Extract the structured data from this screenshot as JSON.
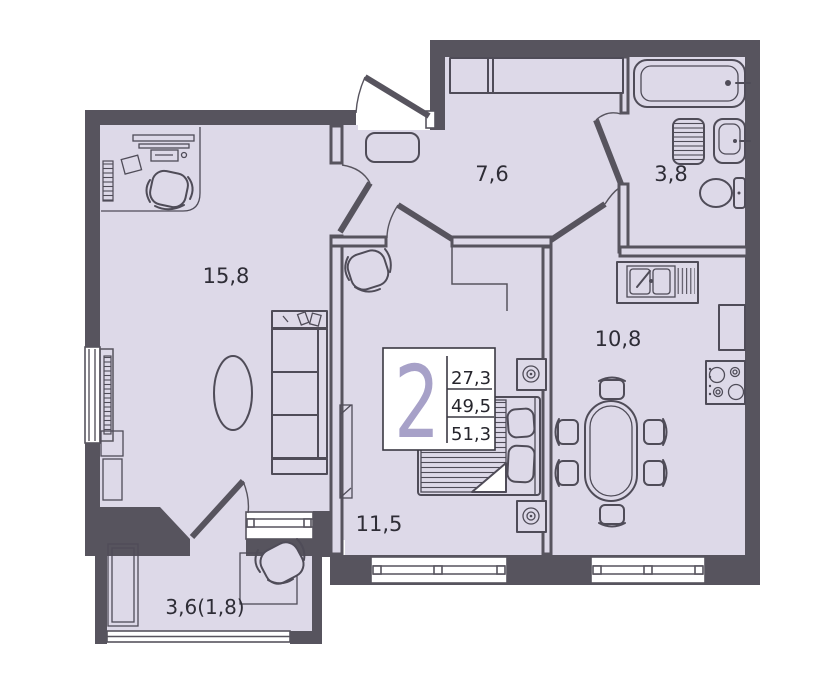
{
  "colors": {
    "wall": "#57545e",
    "floor": "#ddd9e8",
    "line": "#4f4c58",
    "accent": "#a7a1c8",
    "text": "#2e2d36",
    "paper": "#ffffff"
  },
  "rooms": {
    "living": {
      "area": "15,8"
    },
    "hall": {
      "area": "7,6"
    },
    "bathroom": {
      "area": "3,8"
    },
    "kitchen": {
      "area": "10,8"
    },
    "bedroom": {
      "area": "11,5"
    },
    "balcony": {
      "area": "3,6(1,8)"
    }
  },
  "info_box": {
    "rooms_count": "2",
    "areas": [
      "27,3",
      "49,5",
      "51,3"
    ]
  },
  "furniture_icons": [
    "desk",
    "desk-chair",
    "radiator",
    "coffee-table",
    "sofa-shelving",
    "wardrobe",
    "entrance-rug",
    "bathtub",
    "washing-machine",
    "washbasin",
    "toilet",
    "kitchen-sink",
    "stove",
    "kitchen-counter",
    "dining-table",
    "dining-chair",
    "double-bed",
    "pillow",
    "armchair",
    "wall-light",
    "balcony-cabinet",
    "balcony-table",
    "balcony-chair"
  ]
}
